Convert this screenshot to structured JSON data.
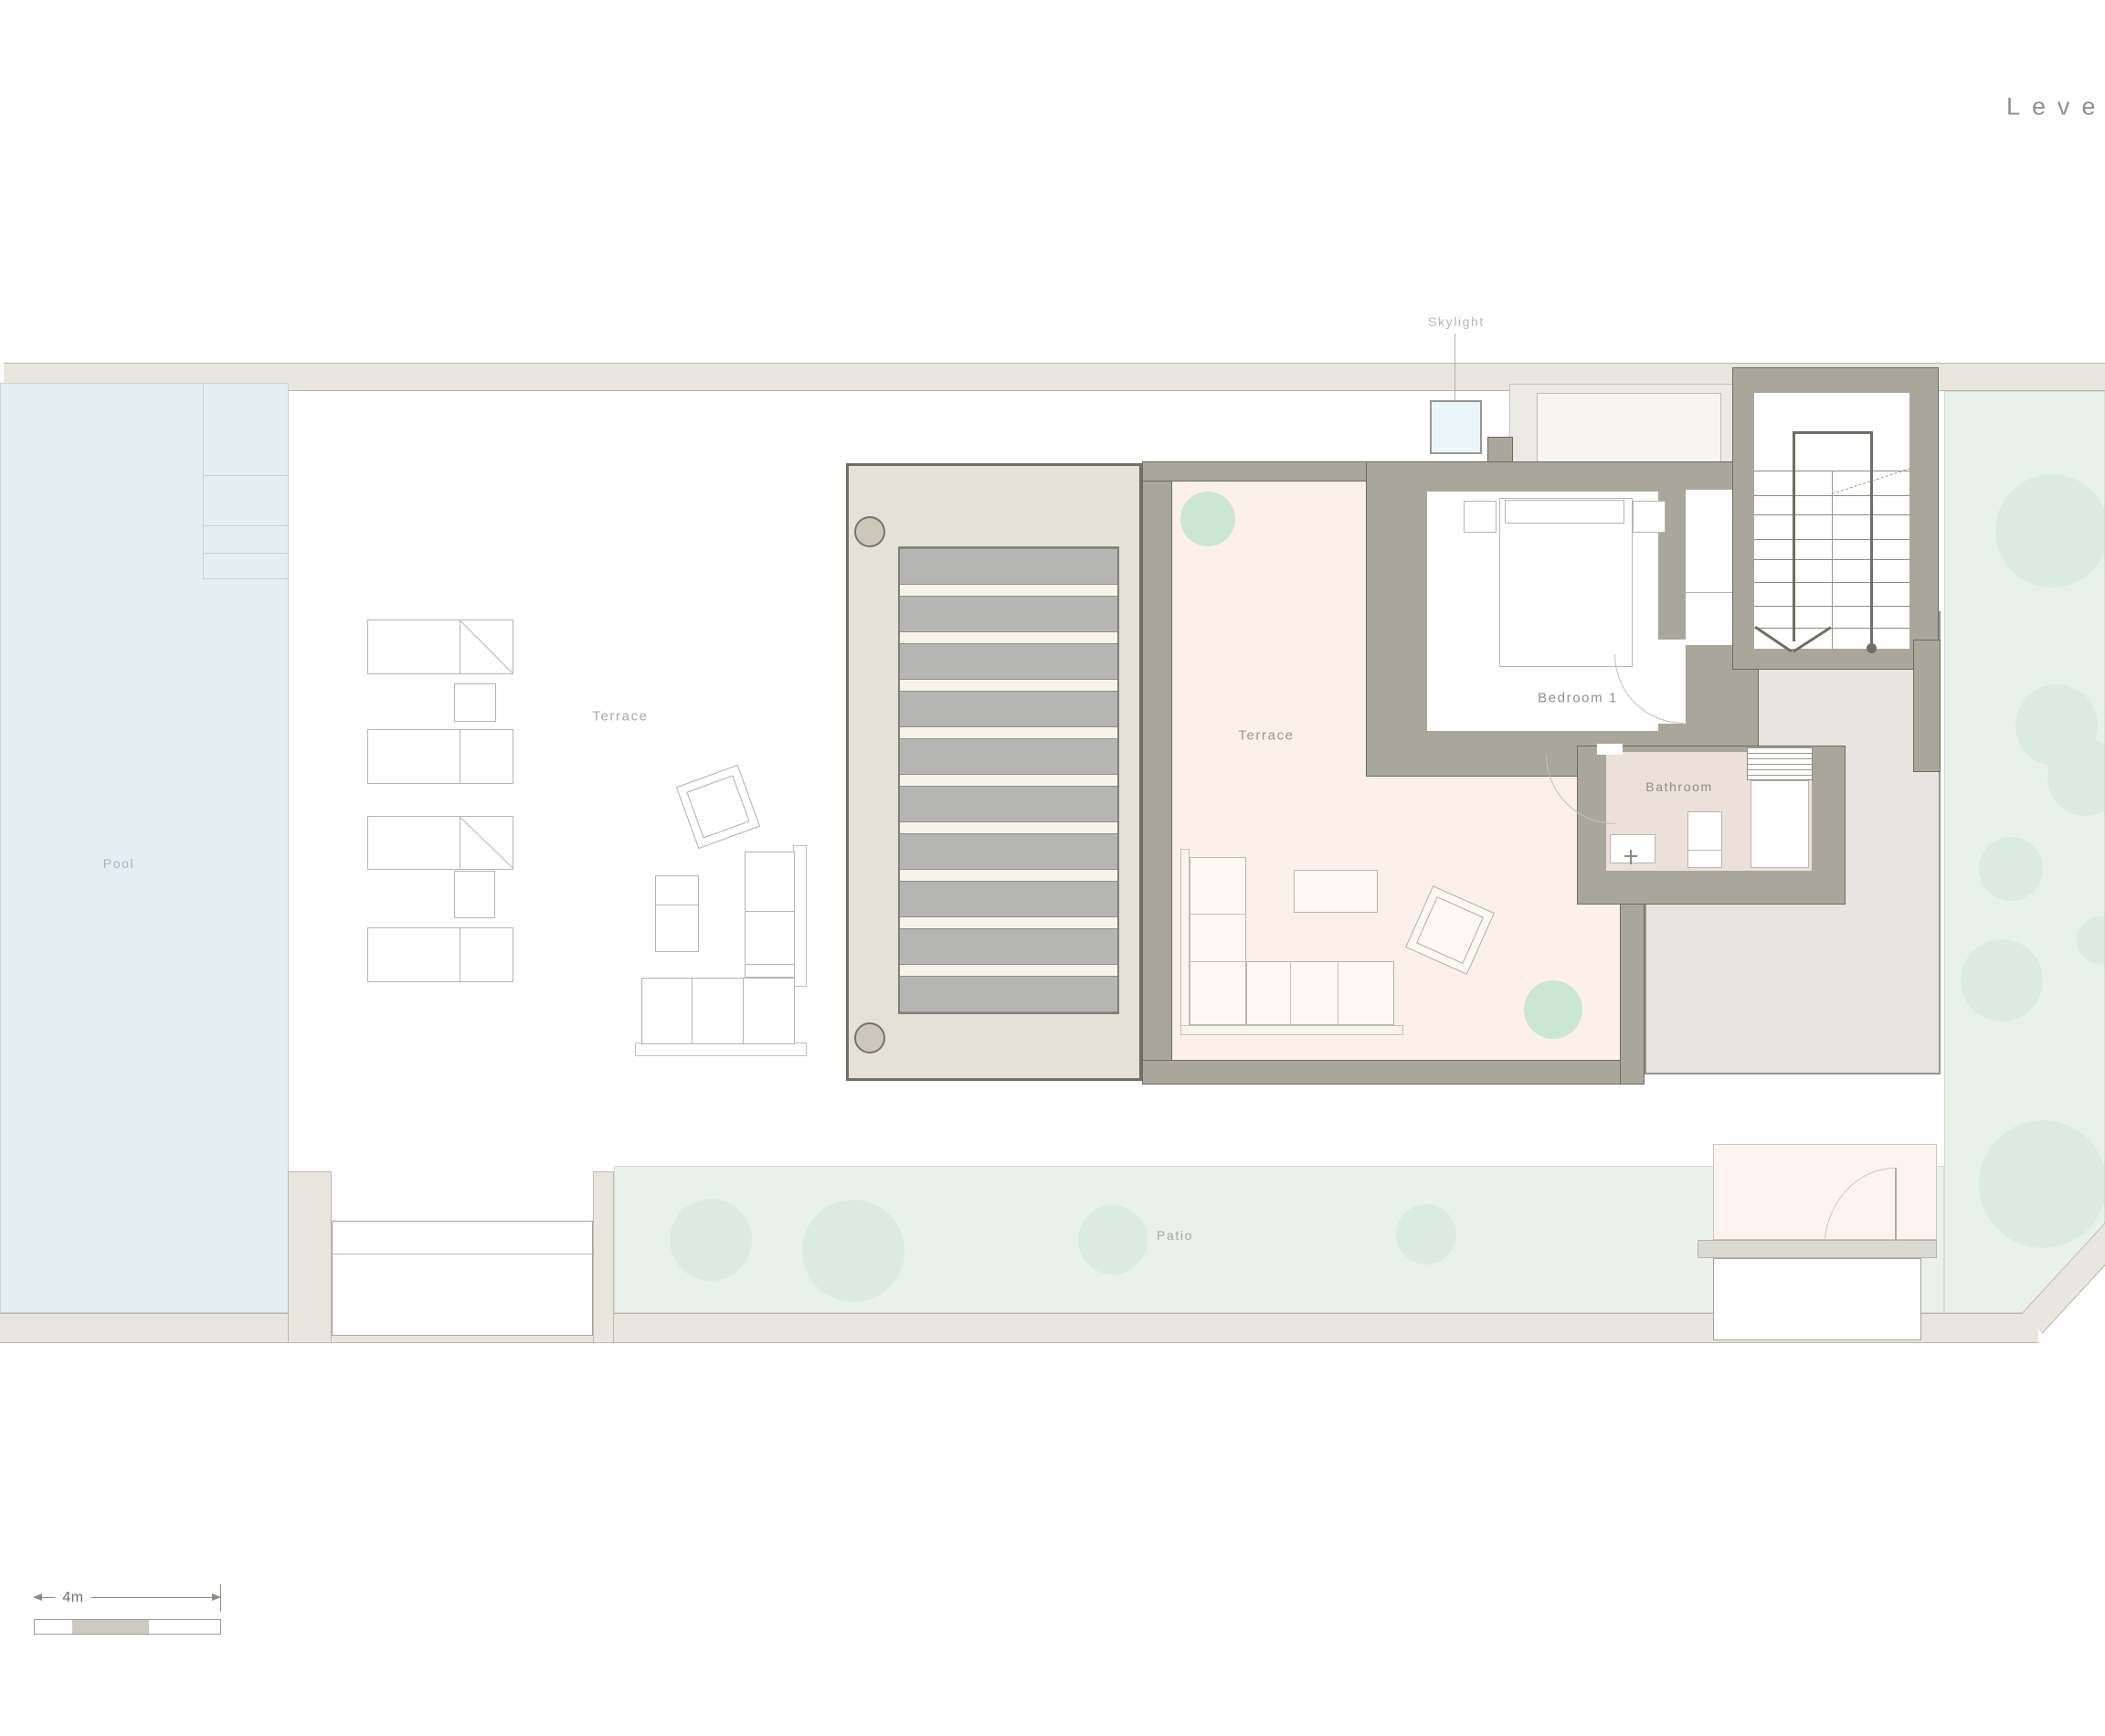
{
  "title": {
    "text": "Level"
  },
  "labels": {
    "pool": "Pool",
    "terrace_left": "Terrace",
    "terrace_main": "Terrace",
    "bedroom": "Bedroom 1",
    "bathroom": "Bathroom",
    "skylight": "Skylight",
    "patio": "Patio"
  },
  "scale_bar": {
    "length_label": "4m"
  },
  "palette": {
    "site_wall": "#e9e6df",
    "pool": "#e4eff4",
    "green": "#e8f2eb",
    "tree": "#dcebe0",
    "deck": "#e4e1d9",
    "slat": "#b5b5b3",
    "building_wall": "#a9a79b",
    "terrace_floor": "#fbf1ea",
    "bathroom_floor": "#ebe1da",
    "skylight": "#eaf7fa",
    "plant": "#cbe7d0"
  }
}
